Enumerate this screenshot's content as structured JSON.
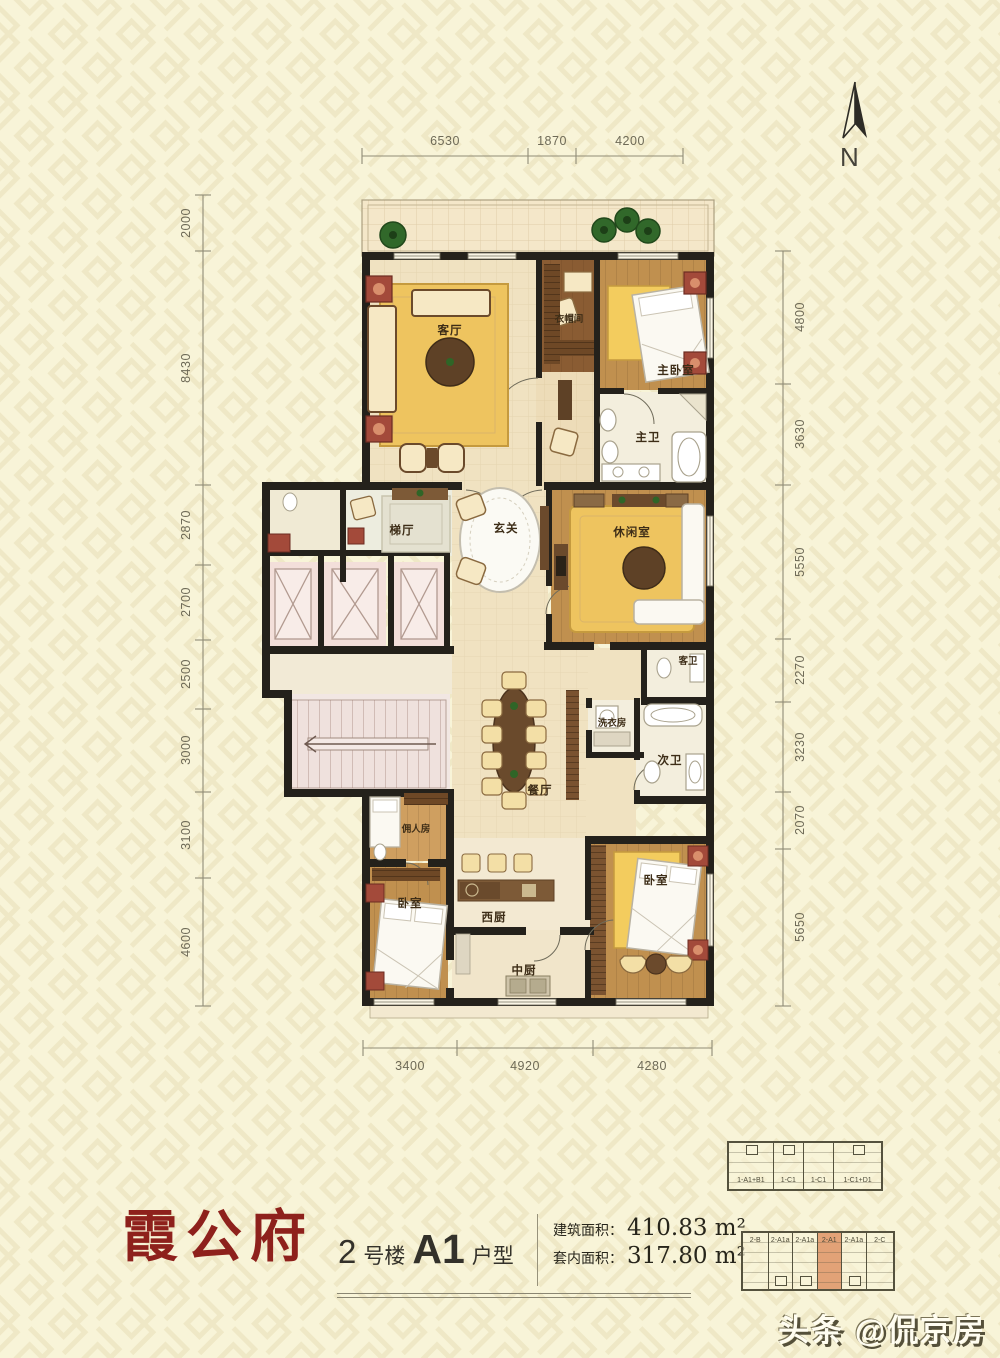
{
  "north_label": "N",
  "logo": {
    "text": "霞公府"
  },
  "unit_info": {
    "building_num": "2",
    "building_suffix": "号楼",
    "unit_code": "A1",
    "unit_suffix": "户型"
  },
  "areas": {
    "gross_label": "建筑面积：",
    "gross_value": "410.83 m²",
    "net_label": "套内面积：",
    "net_value": "317.80 m²"
  },
  "dimensions": {
    "top": [
      "6530",
      "1870",
      "4200"
    ],
    "bottom": [
      "3400",
      "4920",
      "4280"
    ],
    "left": [
      "2000",
      "8430",
      "2870",
      "2700",
      "2500",
      "3000",
      "3100",
      "4600"
    ],
    "right": [
      "4800",
      "3630",
      "5550",
      "2270",
      "3230",
      "2070",
      "5650"
    ]
  },
  "rooms": {
    "living": {
      "label": "客厅"
    },
    "cloak": {
      "label": "衣帽间"
    },
    "master": {
      "label": "主卧室"
    },
    "master_bath": {
      "label": "主卫"
    },
    "lift_hall": {
      "label": "梯厅"
    },
    "foyer": {
      "label": "玄关"
    },
    "lounge": {
      "label": "休闲室"
    },
    "guest_bath": {
      "label": "客卫"
    },
    "laundry": {
      "label": "洗衣房"
    },
    "second_bath": {
      "label": "次卫"
    },
    "dining": {
      "label": "餐厅"
    },
    "maid": {
      "label": "佣人房"
    },
    "bedroom_left": {
      "label": "卧室"
    },
    "kitchen_west": {
      "label": "西厨"
    },
    "kitchen_mid": {
      "label": "中厨"
    },
    "bedroom_right": {
      "label": "卧室"
    }
  },
  "key_plans": {
    "building1": {
      "units": [
        "1-A1+B1",
        "1-C1",
        "1-C1",
        "1-C1+D1"
      ]
    },
    "building2": {
      "units": [
        "2-B",
        "2-A1a",
        "2-A1a",
        "2-A1",
        "2-A1a",
        "2-C"
      ],
      "highlighted": "2-A1"
    }
  },
  "watermark": "头条 @侃京房",
  "colors": {
    "logo_red": "#8e211c",
    "unit_highlight": "#e2a277",
    "wall": "#24211b",
    "rug_yellow": "#eec45f",
    "wood_brown": "#c0904f"
  }
}
